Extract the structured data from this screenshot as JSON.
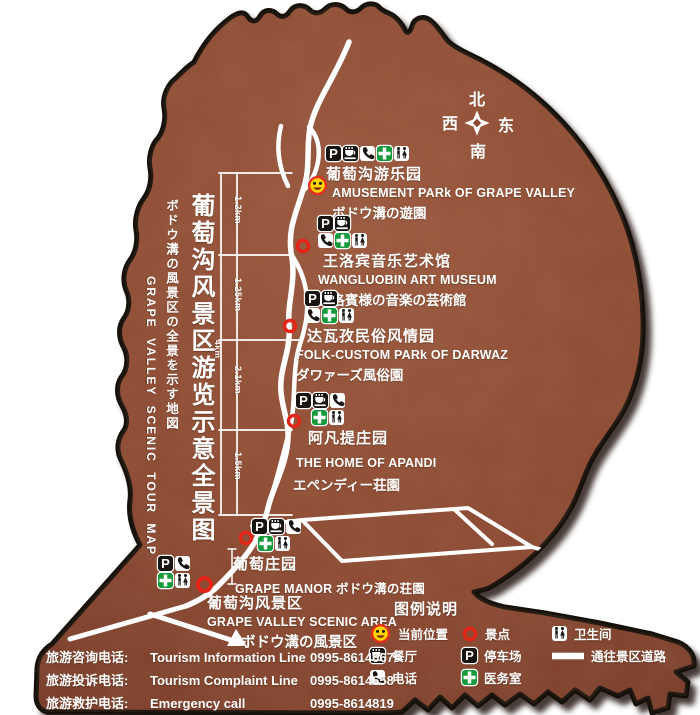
{
  "map": {
    "title_cn": "葡萄沟风景区游览示意全景图",
    "title_jp": "ボドウ溝の風景区の全景を示す地図",
    "title_en": "GRAPE VALLEY SCENIC TOUR MAP",
    "compass": {
      "north": "北",
      "south": "南",
      "east": "东",
      "west": "西"
    },
    "distances": [
      "1.2km",
      "1.25km",
      "2.1km",
      "1.5km"
    ],
    "total_distance": "4km"
  },
  "attractions": [
    {
      "id": "amusement",
      "name_cn": "葡萄沟游乐园",
      "name_en": "AMUSEMENT PARk OF GRAPE VALLEY",
      "name_jp": "ボドウ溝の遊園",
      "icons": [
        [
          "parking",
          "restaurant",
          "phone",
          "medical",
          "toilet"
        ]
      ],
      "marker": "current-location"
    },
    {
      "id": "wangluobin",
      "name_cn": "王洛宾音乐艺术馆",
      "name_en": "WANGLUOBIN ART MUSEUM",
      "name_jp": "王洛賓様の音楽の芸術館",
      "icons": [
        [
          "parking",
          "restaurant"
        ],
        [
          "phone",
          "medical",
          "toilet"
        ]
      ],
      "marker": "scenic-spot"
    },
    {
      "id": "darwaz",
      "name_cn": "达瓦孜民俗风情园",
      "name_en": "FOLK-CUSTOM PARk OF DARWAZ",
      "name_jp": "ダワァーズ風俗園",
      "icons": [
        [
          "parking",
          "restaurant"
        ],
        [
          "phone",
          "medical",
          "toilet"
        ]
      ],
      "marker": "scenic-spot"
    },
    {
      "id": "apandi",
      "name_cn": "阿凡提庄园",
      "name_en": "THE HOME OF APANDI",
      "name_jp": "エペンディー荘園",
      "icons": [
        [
          "parking",
          "restaurant",
          "phone"
        ],
        [
          "medical",
          "toilet"
        ]
      ],
      "marker": "scenic-spot"
    },
    {
      "id": "manor",
      "name_cn": "葡萄庄园",
      "name_en": "GRAPE MANOR ボドウ溝の荘園",
      "icons": [
        [
          "parking",
          "restaurant",
          "phone"
        ],
        [
          "medical",
          "toilet"
        ]
      ],
      "marker": "scenic-spot"
    },
    {
      "id": "entrance",
      "name_cn": "葡萄沟风景区",
      "name_en": "GRAPE VALLEY SCENIC AREA",
      "name_jp": "ボドウ溝の風景区",
      "icons": [
        [
          "parking",
          "phone"
        ],
        [
          "medical",
          "toilet"
        ]
      ],
      "marker": "scenic-spot"
    }
  ],
  "legend": {
    "title": "图例说明",
    "columns": [
      [
        {
          "icon": "current-location",
          "label": "当前位置"
        },
        {
          "icon": "restaurant",
          "label": "餐厅"
        },
        {
          "icon": "phone",
          "label": "电话"
        }
      ],
      [
        {
          "icon": "scenic-spot",
          "label": "景点"
        },
        {
          "icon": "parking",
          "label": "停车场"
        },
        {
          "icon": "medical",
          "label": "医务室"
        }
      ],
      [
        {
          "icon": "toilet",
          "label": "卫生间"
        },
        {
          "icon": "road",
          "label": "通往景区道路"
        }
      ]
    ]
  },
  "hotlines": [
    {
      "label_cn": "旅游咨询电话:",
      "label_en": "Tourism Information Line",
      "number": "0995-8614067"
    },
    {
      "label_cn": "旅游投诉电话:",
      "label_en": "Tourism  Complaint  Line",
      "number": "0995-8614658"
    },
    {
      "label_cn": "旅游救护电话:",
      "label_en": "Emergency  call",
      "number": "0995-8614819"
    }
  ],
  "colors": {
    "map_fill": "#8c4a33",
    "road_white": "#ffffff",
    "marker_red": "#e32417",
    "medical_green": "#169b3c",
    "smiley_yellow": "#ffd400",
    "icon_black": "#171412",
    "outline_black": "#15100a"
  }
}
